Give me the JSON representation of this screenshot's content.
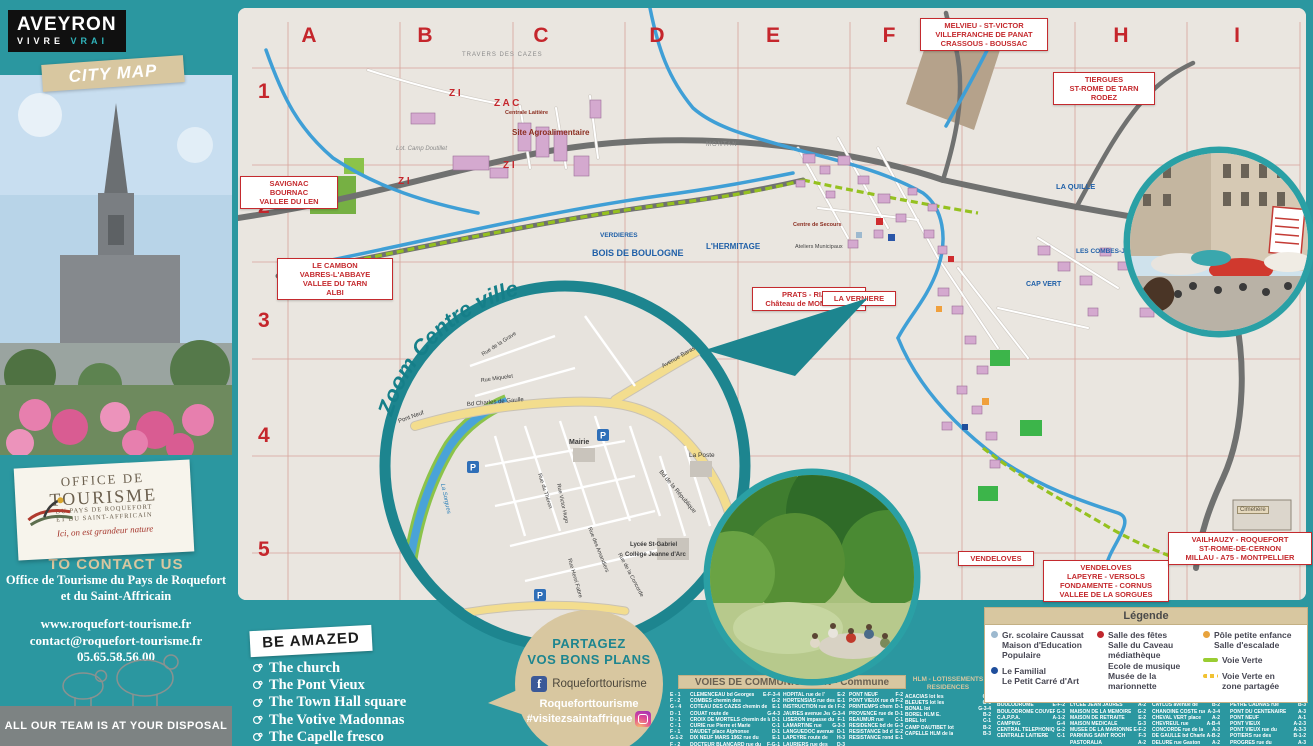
{
  "colors": {
    "teal": "#2b97a0",
    "teal_dark": "#1d858f",
    "beige": "#d8c7a0",
    "sign_red": "#c42a2e",
    "map_paper": "#eae6e0",
    "river_blue": "#3f9fd6",
    "voie_verte_green": "#95c11f",
    "building_pink": "#d4a9cf",
    "facebook_blue": "#3b5998"
  },
  "sidebar": {
    "brand_line1": "AVEYRON",
    "brand_line2": "VIVRE",
    "brand_line3": "VRAI",
    "city_map_label": "CITY MAP",
    "office_sticker": {
      "line1": "OFFICE DE",
      "line2": "TOURISME",
      "line3": "DU PAYS DE ROQUEFORT",
      "line4": "ET DU SAINT-AFFRICAIN",
      "tagline": "Ici, on est grandeur nature"
    },
    "contact": {
      "heading": "TO CONTACT US",
      "org_line1": "Office de Tourisme du Pays de Roquefort",
      "org_line2": "et du Saint-Affricain",
      "website": "www.roquefort-tourisme.fr",
      "email": "contact@roquefort-tourisme.fr",
      "phone": "05.65.58.56.00"
    },
    "footer_note": "ALL OUR TEAM IS AT YOUR DISPOSAL"
  },
  "map": {
    "grid_columns": [
      "A",
      "B",
      "C",
      "D",
      "E",
      "F",
      "G",
      "H",
      "I"
    ],
    "grid_rows": [
      "1",
      "2",
      "3",
      "4",
      "5"
    ],
    "signs": {
      "savignac": [
        "SAVIGNAC",
        "BOURNAC",
        "VALLEE DU LEN"
      ],
      "le_cambon": [
        "LE CAMBON",
        "VABRES-L'ABBAYE",
        "VALLEE DU TARN",
        "ALBI"
      ],
      "melvieu": [
        "MELVIEU - ST-VICTOR",
        "VILLEFRANCHE DE PANAT",
        "CRASSOUS - BOUSSAC"
      ],
      "tiergues": [
        "TIERGUES",
        "ST-ROME DE TARN",
        "RODEZ"
      ],
      "prats": [
        "PRATS - RIALS",
        "Château de MONTAIGUT"
      ],
      "la_verniere": [
        "LA VERNIERE"
      ],
      "vendeloves_small": [
        "VENDELOVES"
      ],
      "vendeloves": [
        "VENDELOVES",
        "LAPEYRE - VERSOLS",
        "FONDAMENTE - CORNUS",
        "VALLEE DE LA SORGUES"
      ],
      "vailhauzy": [
        "VAILHAUZY - ROQUEFORT",
        "ST-ROME-DE-CERNON",
        "MILLAU - A75 - MONTPELLIER"
      ]
    },
    "labels": {
      "travers": "TRAVERS DES CAZES",
      "zi1": "Z I",
      "zi2": "Z I",
      "zi3": "Z I",
      "zac": "Z A C",
      "agro": "Site Agroalimentaire",
      "laitiere": "Centrale Laitière",
      "camp_doutillet": "Lot. Camp Doutillet",
      "montan": "MONTAN",
      "verdieres": "VERDIERES",
      "bois": "BOIS DE BOULOGNE",
      "hermitage": "L'HERMITAGE",
      "quille": "LA QUILLE",
      "combes": "LES COMBES-JUBAC",
      "capvert": "CAP VERT",
      "cimetiere": "Cimetière",
      "secours": "Centre de Secours",
      "ateliers": "Ateliers Municipaux"
    },
    "inset": {
      "title": "Zoom Centre ville",
      "labels": {
        "pont_neuf": "Pont Neuf",
        "gaulle": "Bd Charles de Gaulle",
        "mairie": "Mairie",
        "poste": "La Poste",
        "republique": "Bd de la République",
        "barascud": "Avenue Barascud",
        "lycee": "Lycée St-Gabriel",
        "college": "Collège Jeanne d'Arc",
        "grave": "Rue de la Grave",
        "miquelet": "Rue Miquelet",
        "hugo": "Rue Victor Hugo",
        "theron": "Rue du Théron",
        "amandiers": "Rue des Amandiers",
        "concorde": "Rue de la Concorde",
        "fabre": "Rue Henri Fabre",
        "sorgues": "La Sorgues",
        "parking": "P"
      }
    }
  },
  "be_amazed": {
    "title": "BE AMAZED",
    "items": [
      "The church",
      "The Pont Vieux",
      "The Town Hall square",
      "The Votive Madonnas",
      "The Capelle fresco"
    ]
  },
  "share": {
    "line1": "PARTAGEZ",
    "line2": "VOS BONS PLANS",
    "facebook_account": "Roqueforttourisme",
    "handle_line1": "Roqueforttourisme",
    "handle_line2": "#visitezsaintaffrique"
  },
  "legend": {
    "title": "Légende",
    "items": [
      {
        "marker": "dot",
        "color": "#9db9cf",
        "lines": [
          "Gr. scolaire Caussat",
          "Maison d'Education",
          "Populaire"
        ]
      },
      {
        "marker": "dot",
        "color": "#1f4e9c",
        "lines": [
          "Le Familial",
          "Le Petit Carré d'Art"
        ]
      },
      {
        "marker": "dot",
        "color": "#c0272d",
        "lines": [
          "Salle des fêtes",
          "Salle du Caveau",
          "médiathèque",
          "Ecole de musique",
          "Musée de la marionnette"
        ]
      },
      {
        "marker": "dot",
        "color": "#e8a33d",
        "lines": [
          "Pôle petite enfance",
          "Salle d'escalade"
        ]
      },
      {
        "marker": "line",
        "color": "#9acd32",
        "lines": [
          "Voie Verte"
        ]
      },
      {
        "marker": "dash",
        "color": "#f1c232",
        "lines": [
          "Voie Verte en",
          "zone partagée"
        ]
      }
    ]
  },
  "voies": {
    "title": "VOIES DE COMMUNICATION - Commune",
    "left_refs": [
      "E - 1",
      "F - 2",
      "G - 4",
      "D - 1",
      "D - 1",
      "C - 1",
      "F - 1",
      "G-1-2",
      "F - 2"
    ],
    "col1": [
      {
        "n": "CLEMENCEAU bd Georges",
        "r": "E-F-3-4"
      },
      {
        "n": "COMBES chemin des",
        "r": "G-2"
      },
      {
        "n": "COTEAU DES CAZES chemin de",
        "r": "E-1"
      },
      {
        "n": "COUAT route de",
        "r": "G-4-3"
      },
      {
        "n": "CROIX DE MORTELS chemin de la",
        "r": "D-1"
      },
      {
        "n": "CURIE rue Pierre et Marie",
        "r": "C-1"
      },
      {
        "n": "DAUDET place Alphonse",
        "r": "D-1"
      },
      {
        "n": "DIX NEUF MARS 1962 rue du",
        "r": "E-1"
      },
      {
        "n": "DOCTEUR BLANCARD rue du",
        "r": "F-G-1"
      }
    ],
    "col2": [
      {
        "n": "HOPITAL rue de l'",
        "r": "E-2"
      },
      {
        "n": "HORTENSIAS rue des",
        "r": "E-1"
      },
      {
        "n": "INSTRUCTION rue de l'",
        "r": "F-2"
      },
      {
        "n": "JAURES avenue Jean",
        "r": "G-3-4"
      },
      {
        "n": "LISERON impasse du",
        "r": "F-1"
      },
      {
        "n": "LAMARTINE rue",
        "r": "G-3-3"
      },
      {
        "n": "LANGUEDOC avenue du",
        "r": "D-1"
      },
      {
        "n": "LAPEYRE route de",
        "r": "H-3"
      },
      {
        "n": "LAURIERS rue des",
        "r": "D-3"
      }
    ],
    "col3": [
      {
        "n": "PONT NEUF",
        "r": "F-2"
      },
      {
        "n": "PONT VIEUX rue du",
        "r": "F-2"
      },
      {
        "n": "PRINTEMPS chemin du",
        "r": "D-1"
      },
      {
        "n": "PROVENCE rue de",
        "r": "D-1"
      },
      {
        "n": "REAUMUR rue",
        "r": "C-1"
      },
      {
        "n": "RESIDENCE bd de la",
        "r": "G-3"
      },
      {
        "n": "RESISTANCE bd de la",
        "r": "E-2"
      },
      {
        "n": "RESISTANCE rond point de la",
        "r": "E-1"
      }
    ]
  },
  "hlm": {
    "title_line1": "HLM - LOTISSEMENTS",
    "title_line2": "RESIDENCES",
    "items": [
      {
        "n": "ACACIAS lot les",
        "r": "G-4"
      },
      {
        "n": "BLEUETS lot les",
        "r": "G-6"
      },
      {
        "n": "BONAL lot",
        "r": "G-3-4"
      },
      {
        "n": "BOREL HLM E.",
        "r": "B-2"
      },
      {
        "n": "BREL lot",
        "r": "C-1"
      },
      {
        "n": "CAMP DAUTIBET lot",
        "r": "B-2"
      },
      {
        "n": "CAPELLE HLM de la",
        "r": "B-3"
      }
    ]
  },
  "places": {
    "col1": [
      {
        "n": "ATELIERS MUNICIPAUX",
        "r": "C-2/E-2"
      },
      {
        "n": "BIBLIOTHEQUE",
        "r": "F-2"
      },
      {
        "n": "BOULODROME",
        "r": "E-F-2"
      },
      {
        "n": "BOULODROME COUVERT",
        "r": "G-3"
      },
      {
        "n": "C.A.P.P.A.",
        "r": "A-1-2"
      },
      {
        "n": "CAMPING",
        "r": "G-4"
      },
      {
        "n": "CENTRAL TELEPHONIQUE",
        "r": "G-2"
      },
      {
        "n": "CENTRALE LAITIERE",
        "r": "C-1"
      }
    ],
    "col2": [
      {
        "n": "LYCEE AGRICOLE",
        "r": ""
      },
      {
        "n": "DE LA CAZOTTE",
        "r": "A-1"
      },
      {
        "n": "LYCEE JEAN JAURES",
        "r": "A-2"
      },
      {
        "n": "MAISON DE LA MEMOIRE",
        "r": "G-2"
      },
      {
        "n": "MAISON DE RETRAITE",
        "r": "E-2"
      },
      {
        "n": "MAISON MEDICALE",
        "r": "G-3"
      },
      {
        "n": "MUSEE DE LA MARIONNETTE",
        "r": "E-F-2"
      },
      {
        "n": "PARKING SAINT ROCH",
        "r": "F-3"
      },
      {
        "n": "PASTORALIA",
        "r": "A-2"
      }
    ]
  },
  "streets_right": {
    "col1": [
      {
        "n": "CARTAILLAC rue E.",
        "r": "B-4"
      },
      {
        "n": "CASERNES place des",
        "r": "A-3"
      },
      {
        "n": "CAYLUS avenue de",
        "r": "B-2"
      },
      {
        "n": "CHANOINE COSTE rue",
        "r": "A-3-4"
      },
      {
        "n": "CHEVAL VERT place",
        "r": "A-2"
      },
      {
        "n": "CHEVREUL rue",
        "r": "A-B-4"
      },
      {
        "n": "CONCORDE rue de la",
        "r": "A-3"
      },
      {
        "n": "DE GAULLE bd Charles",
        "r": "A-B-2"
      },
      {
        "n": "DELURE rue Gaston",
        "r": "A-2"
      }
    ],
    "col2": [
      {
        "n": "PASTEUR BOREL rue",
        "r": "B-3"
      },
      {
        "n": "PASTEUR rue",
        "r": "B-3"
      },
      {
        "n": "PEYRE CADNAS rue",
        "r": "B-3"
      },
      {
        "n": "PONT DU CENTENAIRE",
        "r": "A-3"
      },
      {
        "n": "PONT NEUF",
        "r": "A-1"
      },
      {
        "n": "PONT VIEUX",
        "r": "A-2-3"
      },
      {
        "n": "PONT VIEUX rue du",
        "r": "A-3-3"
      },
      {
        "n": "POTIERS rue des",
        "r": "B-1-2"
      },
      {
        "n": "PROGRES rue du",
        "r": "A-3"
      }
    ]
  }
}
